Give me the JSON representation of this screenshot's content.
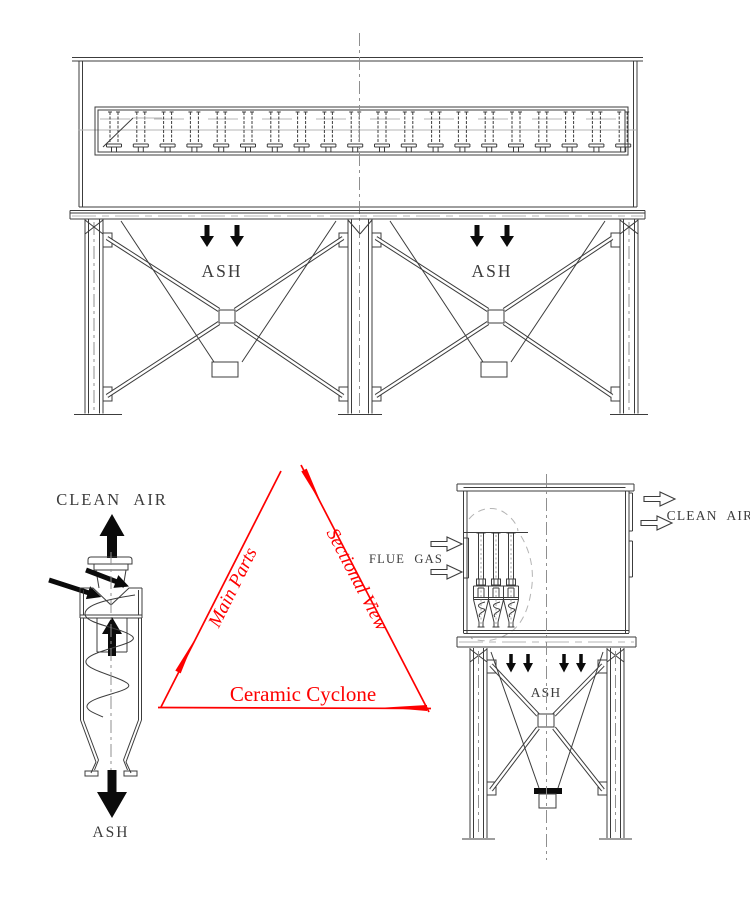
{
  "colors": {
    "background": "#ffffff",
    "line": "#3c3c3c",
    "centerline": "#8f8f8f",
    "light": "#b4b4b4",
    "arrow-black": "#0b0b0b",
    "accent": "#fe0000"
  },
  "front_view": {
    "hopper_left_label": "ASH",
    "hopper_right_label": "ASH"
  },
  "cyclone_detail": {
    "outlet_label": "CLEAN AIR",
    "bottom_label": "ASH"
  },
  "sectional_view": {
    "inlet_label": "FLUE GAS",
    "outlet_label": "CLEAN AIR",
    "hopper_label": "ASH"
  },
  "triangle": {
    "left_edge_label": "Main Parts",
    "right_edge_label": "Sectional View",
    "bottom_edge_label": "Ceramic Cyclone"
  }
}
